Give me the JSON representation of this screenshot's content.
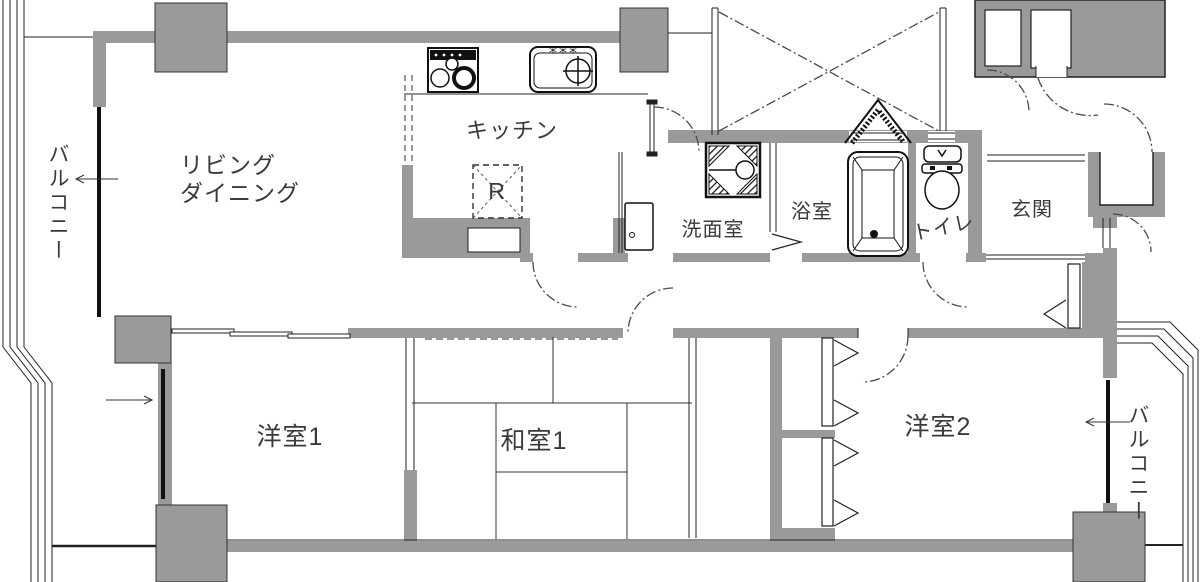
{
  "rooms": {
    "balcony_left": {
      "label": "バルコニー"
    },
    "living": {
      "line1": "リビング",
      "line2": "ダイニング"
    },
    "kitchen": {
      "label": "キッチン"
    },
    "refrigerator": {
      "label": "R"
    },
    "washroom": {
      "label": "洗面室"
    },
    "bathroom": {
      "label": "浴室"
    },
    "toilet": {
      "label": "トイレ"
    },
    "entrance": {
      "label": "玄関"
    },
    "western_room_1": {
      "label": "洋室1"
    },
    "japanese_room_1": {
      "label": "和室1"
    },
    "western_room_2": {
      "label": "洋室2"
    },
    "balcony_right": {
      "label": "バルコニー"
    }
  },
  "fixtures": [
    "stove-icon",
    "sink-icon",
    "refrigerator-space",
    "washing-machine-pan-icon",
    "bathtub-icon",
    "toilet-icon",
    "cabinet-icon",
    "closet-folding-doors"
  ],
  "colors": {
    "wall": "#9a9a9a",
    "line": "#1c1c1c",
    "dashdot": "#4a4a4a",
    "text": "#3a3a3a",
    "background": "#ffffff"
  }
}
